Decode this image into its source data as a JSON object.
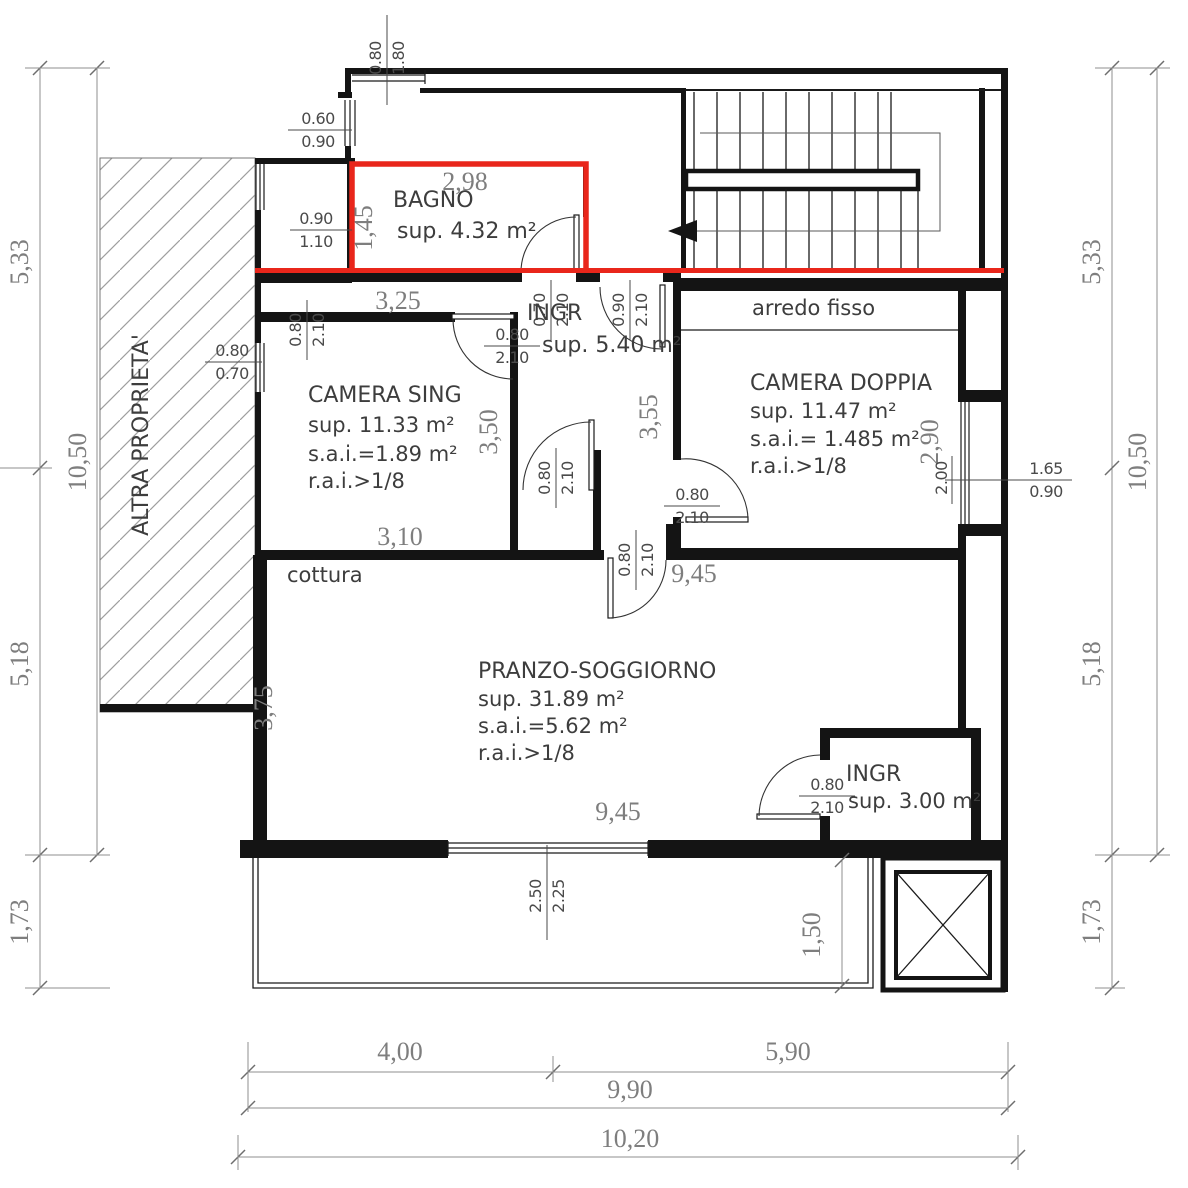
{
  "labels": {
    "altra_proprieta": "ALTRA PROPRIETA'",
    "arredo_fisso": "arredo fisso",
    "cottura": "cottura"
  },
  "rooms": {
    "bagno": {
      "name": "BAGNO",
      "sup": "sup. 4.32 m²"
    },
    "ingresso": {
      "name": "INGR",
      "sup": "sup. 5.40 m²"
    },
    "camera_singola": {
      "name": "CAMERA SING",
      "sup": "sup. 11.33 m²",
      "sai": "s.a.i.=1.89 m²",
      "rai": "r.a.i.>1/8"
    },
    "camera_doppia": {
      "name": "CAMERA DOPPIA",
      "sup": "sup. 11.47 m²",
      "sai": "s.a.i.= 1.485 m²",
      "rai": "r.a.i.>1/8"
    },
    "pranzo": {
      "name": "PRANZO-SOGGIORNO",
      "sup": "sup. 31.89 m²",
      "sai": "s.a.i.=5.62 m²",
      "rai": "r.a.i.>1/8"
    },
    "ingresso2": {
      "name": "INGR",
      "sup": "sup. 3.00 m²"
    }
  },
  "dimensions": {
    "outer": {
      "v_seg1": "5,33",
      "v_seg2": "5,18",
      "v_seg3": "1,73",
      "v_total": "10,50",
      "h_seg1": "4,00",
      "h_seg2": "5,90",
      "h_sub": "9,90",
      "h_total": "10,20"
    },
    "inner": {
      "bagno_width": "2,98",
      "bagno_height": "1,45",
      "sing_top": "3,25",
      "sing_bottom": "3,10",
      "sing_height": "3,50",
      "hall_height": "3,55",
      "doppia_height": "2,90",
      "doppia_window_offset": "2.00",
      "living_top": "9,45",
      "living_bottom": "9,45",
      "living_height": "3,75",
      "balcony_depth": "1,50"
    },
    "openings": {
      "top_win": {
        "a": "0.80",
        "b": "1.80"
      },
      "small_win": {
        "a": "0.60",
        "b": "0.90"
      },
      "recess_win": {
        "a": "0.90",
        "b": "1.10"
      },
      "sing_win": {
        "a": "0.80",
        "b": "0.70"
      },
      "sing_door": {
        "a": "0.80",
        "b": "2.10"
      },
      "bagno_door": {
        "a": "0.70",
        "b": "2.10"
      },
      "entry_door": {
        "a": "0.90",
        "b": "2.10"
      },
      "ingr_door": {
        "a": "0.80",
        "b": "2.10"
      },
      "closet_door": {
        "a": "0.80",
        "b": "2.10"
      },
      "doppia_door": {
        "a": "0.80",
        "b": "2.10"
      },
      "living_door": {
        "a": "0.80",
        "b": "2.10"
      },
      "ingr2_door": {
        "a": "0.80",
        "b": "2.10"
      },
      "living_win": {
        "a": "2.50",
        "b": "2.25"
      },
      "doppia_win": {
        "a": "1.65",
        "b": "0.90"
      }
    },
    "colors": {
      "highlight_red": "#e9261b",
      "dim_gray": "#7e7e7e",
      "wall_black": "#141414"
    }
  }
}
